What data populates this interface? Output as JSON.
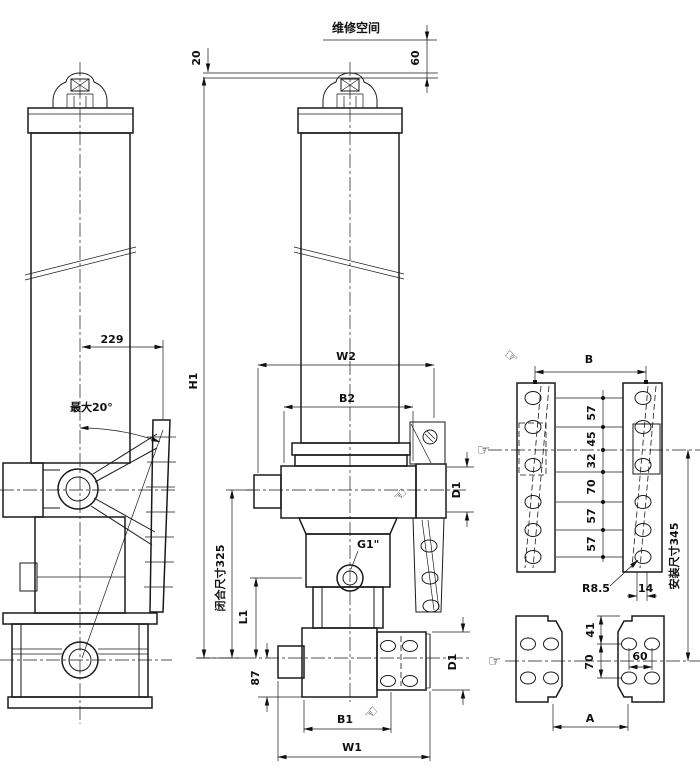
{
  "colors": {
    "line": "#1a1a1a",
    "background": "#ffffff"
  },
  "top_annotations": {
    "service_space": "维修空间",
    "clearance": "60",
    "rod_offset": "20"
  },
  "side_view": {
    "trunnion_offset": "229",
    "max_tilt_angle": "最大20°"
  },
  "front_view": {
    "overall_height": "H1",
    "top_width": "W2",
    "body_width": "B2",
    "plate_hole_dia_top": "D1",
    "closed_length": "闭合尺寸325",
    "lower_length": "L1",
    "base_offset": "87",
    "oil_port": "G1\"",
    "base_width_b1": "B1",
    "base_width_w1": "W1",
    "plate_hole_dia_bottom": "D1"
  },
  "plate_detail": {
    "plate_spacing": "B",
    "hole_pitches": [
      "57",
      "45",
      "32",
      "70",
      "57",
      "57"
    ],
    "slot_radius": "R8.5",
    "slot_width": "14",
    "install_length": "安装尺寸345"
  },
  "base_plate_detail": {
    "top_pitch": "41",
    "row_pitch": "70",
    "col_pitch": "60",
    "plate_spacing": "A"
  },
  "icons": {
    "pointing_hand_right": "☞",
    "pointing_hand_left": "☜"
  }
}
